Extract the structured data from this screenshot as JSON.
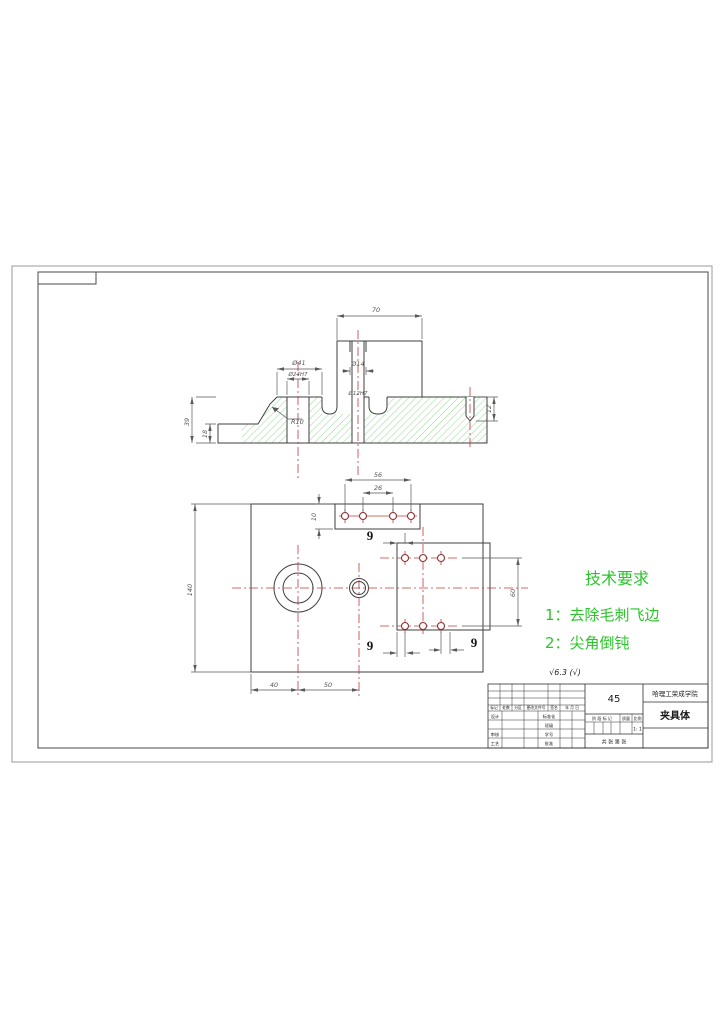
{
  "colors": {
    "outline": "#3f3f3f",
    "centerline": "#c43b3b",
    "hatch_green": "#9cdc9c",
    "hole_ring": "#8b3030",
    "tech_text_green": "#2bc52b"
  },
  "section_view": {
    "dims": {
      "width70": "70",
      "dia41": "Ø41",
      "dia24": "Ø24H7",
      "dia14": "Ø14",
      "dia12": "Ø12H7",
      "radius10": "R10",
      "height39": "39",
      "height18": "18",
      "depth12": "12"
    }
  },
  "plan_view": {
    "dims": {
      "span56": "56",
      "span26": "26",
      "tab10": "10",
      "height140": "140",
      "span60": "60",
      "offset40": "40",
      "offset50": "50",
      "pitch9": "9"
    }
  },
  "tech_requirements": {
    "title": "技术要求",
    "item1": "1：去除毛刺飞边",
    "item2": "2：尖角倒钝"
  },
  "surface_note": "√6.3 (√)",
  "title_block": {
    "material": "45",
    "school": "哈理工荣成学院",
    "part_name": "夹具体",
    "revision": [
      "标记",
      "处数",
      "分区",
      "更改文件号",
      "签名",
      "年 月 日"
    ],
    "sign_rows": {
      "design": "设计",
      "check": "审核",
      "process": "工艺",
      "standard": "标准化",
      "class": "班级",
      "student_no": "学号",
      "approve": "批准"
    },
    "stage": "阶 段 标 记",
    "mass": "质量",
    "scale": "比例",
    "scale_value": "1: 1",
    "sheet": "共  张  第  张"
  }
}
